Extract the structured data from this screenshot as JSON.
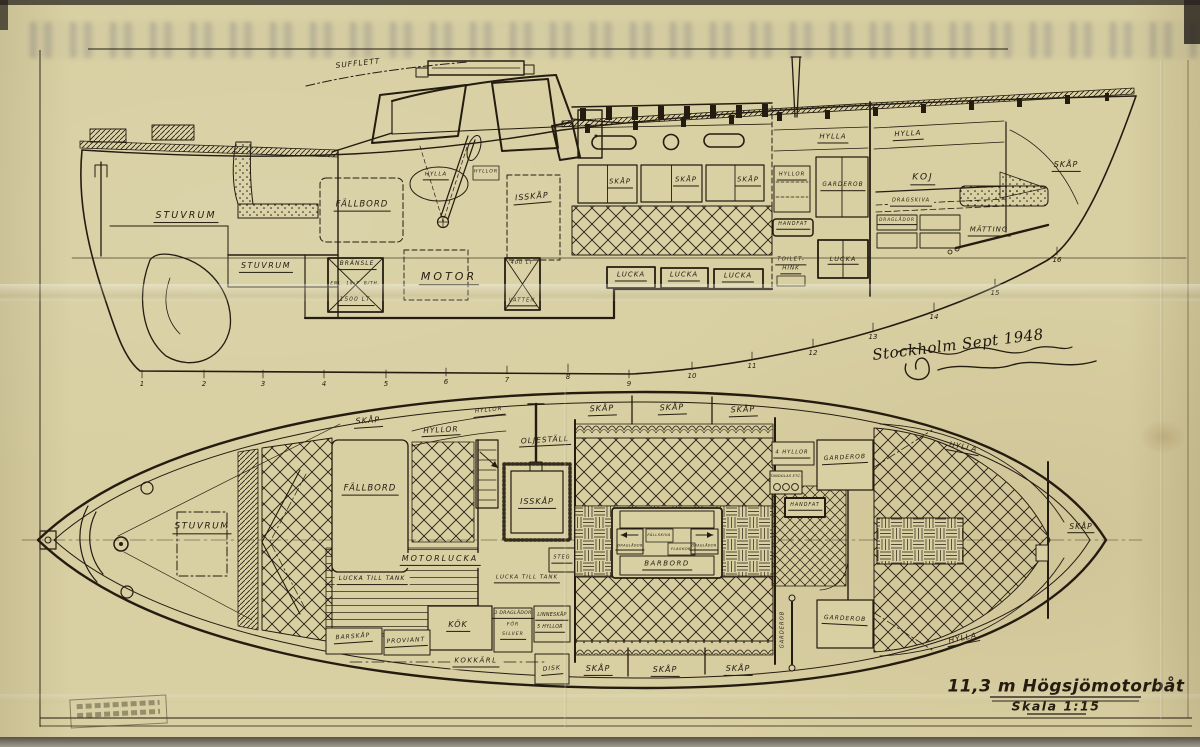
{
  "title": {
    "main": "11,3 m Högsjömotorbåt",
    "scale": "Skala 1:15"
  },
  "signature": "Stockholm Sept 1948",
  "stations": [
    "1",
    "2",
    "3",
    "4",
    "5",
    "6",
    "7",
    "8",
    "9",
    "10",
    "11",
    "12",
    "13",
    "14",
    "15",
    "16"
  ],
  "profile": {
    "sufflett": "SUFFLETT",
    "stuvrum_aft": "STUVRUM",
    "stuvrum_cockpit": "STUVRUM",
    "fallbord": "FÄLLBORD",
    "hylla_wheelhouse": "HYLLA",
    "hyllor_wheelhouse": "HYLLOR",
    "isskap": "ISSKÅP",
    "motor": "MOTOR",
    "bransle": "BRÄNSLE",
    "bransle_note_l": "ENL. 18:7",
    "bransle_note_r": "B/TH.",
    "bransle_vol": "1500 LT.",
    "vatten_vol": "400 LT",
    "vatten": "VATTEN",
    "skap_1": "SKÅP",
    "skap_2": "SKÅP",
    "skap_3": "SKÅP",
    "lucka_1": "LUCKA",
    "lucka_2": "LUCKA",
    "lucka_3": "LUCKA",
    "hylla_wc": "HYLLA",
    "hylla_fore": "HYLLA",
    "hyllor_wc": "HYLLOR",
    "garderob": "GARDEROB",
    "handfat": "HANDFAT",
    "toilet_line1": "TOILET-",
    "toilet_line2": "HINK",
    "lucka_wc": "LUCKA",
    "koj": "KOJ",
    "dragskiva": "DRAGSKIVA",
    "draglador": "DRAGLÅDOR",
    "matting": "MÄTTING",
    "skap_bow": "SKÅP"
  },
  "plan": {
    "stuvrum": "STUVRUM",
    "skap_aft": "SKÅP",
    "hyllor_a": "HYLLOR",
    "hyllor_b": "HYLLOR",
    "oljestall": "OLJESTÄLL",
    "fallbord": "FÄLLBORD",
    "isskap": "ISSKÅP",
    "motorlucka": "MOTORLUCKA",
    "lucka_tank_1": "LUCKA TILL TANK",
    "lucka_tank_2": "LUCKA TILL TANK",
    "steg": "STEG",
    "skap_top_1": "SKÅP",
    "skap_top_2": "SKÅP",
    "skap_top_3": "SKÅP",
    "skap_bot_1": "SKÅP",
    "skap_bot_2": "SKÅP",
    "skap_bot_3": "SKÅP",
    "barbord": "BARBORD",
    "fallskiva": "FÄLLSKIVA",
    "flaskor": "FLASKOR",
    "draglador_l": "DRAGLÅDOR",
    "draglador_r": "DRAGLÅDOR",
    "kok": "KÖK",
    "silver_1": "3 DRAGLÅDOR",
    "silver_2": "FÖR",
    "silver_3": "SILVER",
    "linneskap_1": "LINNESKÅP",
    "linneskap_2": "5 HYLLOR",
    "kokkarl": "KOKKÄRL",
    "disk": "DISK",
    "barskap": "BARSKÅP",
    "proviant": "PROVIANT",
    "hyllor_4": "4 HYLLOR",
    "garderob_top": "GARDEROB",
    "garderob_bottom": "GARDEROB",
    "garderob_vertical": "GARDEROB",
    "tandglas": "TANDGLAS ETC.",
    "handfat": "HANDFAT",
    "hylla_top": "HYLLA",
    "hylla_bottom": "HYLLA",
    "skap_bow": "SKÅP"
  },
  "colors": {
    "paper": "#d8cfa2",
    "ink": "#241c10"
  }
}
